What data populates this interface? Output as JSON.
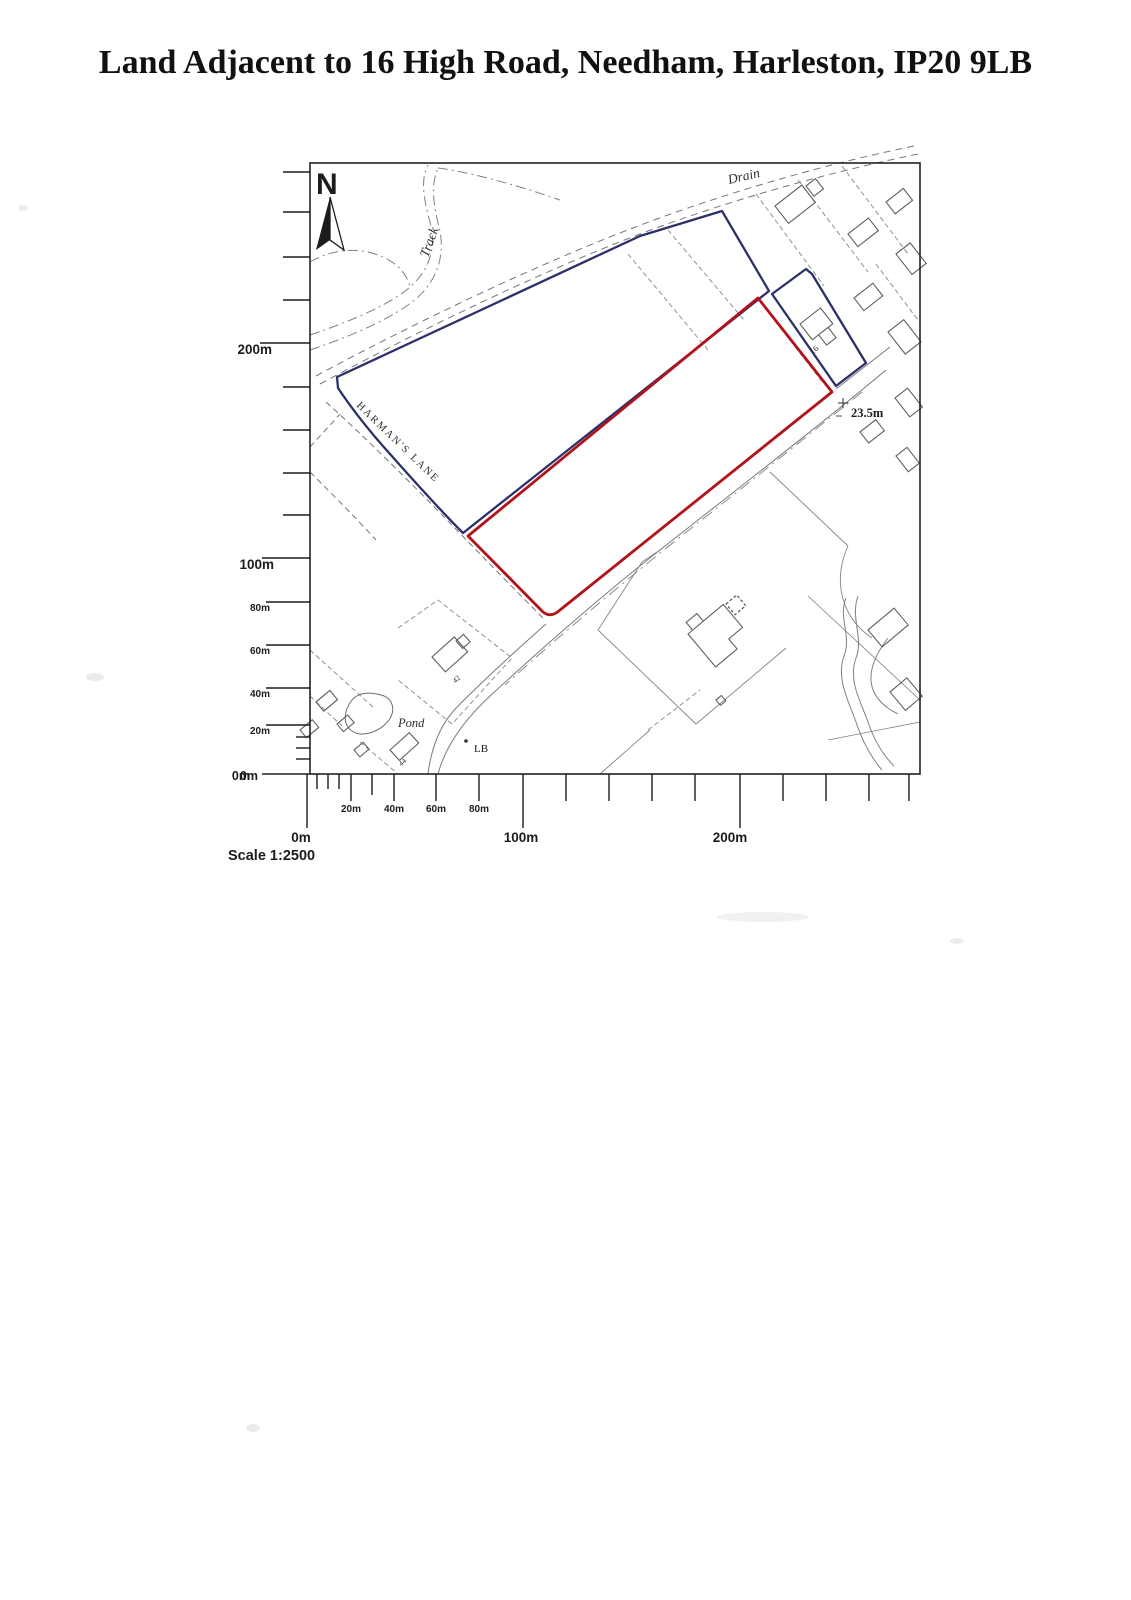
{
  "document": {
    "title": "Land Adjacent to 16 High Road, Needham, Harleston, IP20 9LB"
  },
  "map": {
    "north_label": "N",
    "labels": {
      "drain": "Drain",
      "track": "Track",
      "harmans_lane": "HARMAN'S LANE",
      "spot_height": "23.5m",
      "pond": "Pond",
      "letter_box": "LB",
      "house_16": "16",
      "house_42": "42",
      "house_44": "44"
    },
    "colors": {
      "red_boundary": "#b2121a",
      "blue_boundary": "#2b3069",
      "base_lines": "#757575",
      "ink": "#1c1c1c"
    }
  },
  "scales": {
    "left_axis_labels": [
      "200m",
      "100m",
      "80m",
      "60m",
      "40m",
      "20m",
      "0m"
    ],
    "bottom_small_labels": [
      "20m",
      "40m",
      "60m",
      "80m"
    ],
    "bottom_big_labels": [
      "0m",
      "100m",
      "200m"
    ],
    "axis_zero_label": "0m",
    "scale_text": "Scale 1:2500"
  }
}
